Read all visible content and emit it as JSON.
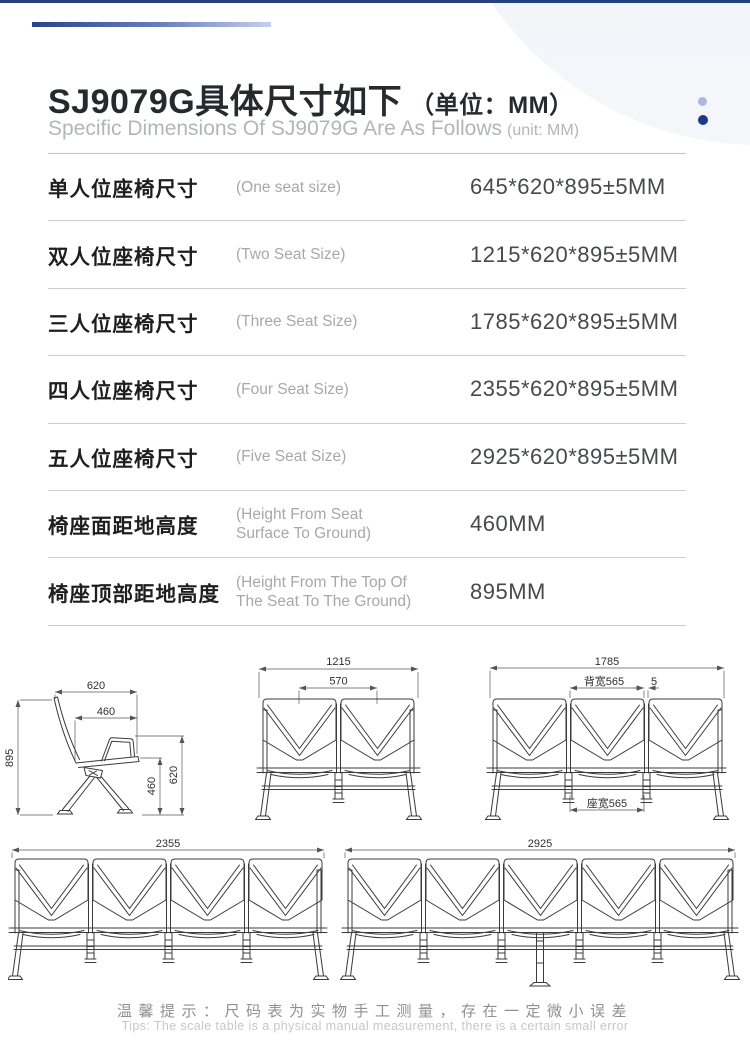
{
  "header": {
    "title": "SJ9079G具体尺寸如下",
    "title_unit": "（单位：MM）",
    "subtitle": "Specific Dimensions Of SJ9079G Are As Follows",
    "subtitle_unit": "(unit: MM)"
  },
  "spec_table": {
    "rows": [
      {
        "label_cn": "单人位座椅尺寸",
        "label_en": "(One seat size)",
        "value": "645*620*895±5MM"
      },
      {
        "label_cn": "双人位座椅尺寸",
        "label_en": "(Two Seat Size)",
        "value": "1215*620*895±5MM"
      },
      {
        "label_cn": "三人位座椅尺寸",
        "label_en": "(Three Seat Size)",
        "value": "1785*620*895±5MM"
      },
      {
        "label_cn": "四人位座椅尺寸",
        "label_en": "(Four Seat Size)",
        "value": "2355*620*895±5MM"
      },
      {
        "label_cn": "五人位座椅尺寸",
        "label_en": "(Five Seat Size)",
        "value": "2925*620*895±5MM"
      },
      {
        "label_cn": "椅座面距地高度",
        "label_en": "(Height From Seat Surface To Ground)",
        "value": "460MM"
      },
      {
        "label_cn": "椅座顶部距地高度",
        "label_en": "(Height From The Top Of The Seat To The Ground)",
        "value": "895MM"
      }
    ]
  },
  "drawings": {
    "single_side_view": {
      "width_top": "620",
      "depth_inner": "460",
      "height_total": "895",
      "height_seat": "460",
      "height_back": "620"
    },
    "two_seat": {
      "width_total": "1215",
      "width_inner": "570"
    },
    "three_seat": {
      "width_total": "1785",
      "back_width": "背宽565",
      "gap": "5",
      "seat_width": "座宽565"
    },
    "four_seat": {
      "width_total": "2355"
    },
    "five_seat": {
      "width_total": "2925"
    }
  },
  "footer": {
    "tip_cn": "温馨提示：尺码表为实物手工测量，存在一定微小误差",
    "tip_en": "Tips: The scale table is a physical manual measurement, there is a certain small error"
  },
  "colors": {
    "accent_navy": "#24407e",
    "dot_light": "#a9b8de",
    "dot_dark": "#1a3a8c",
    "line_drawing": "#3b3b3b"
  }
}
